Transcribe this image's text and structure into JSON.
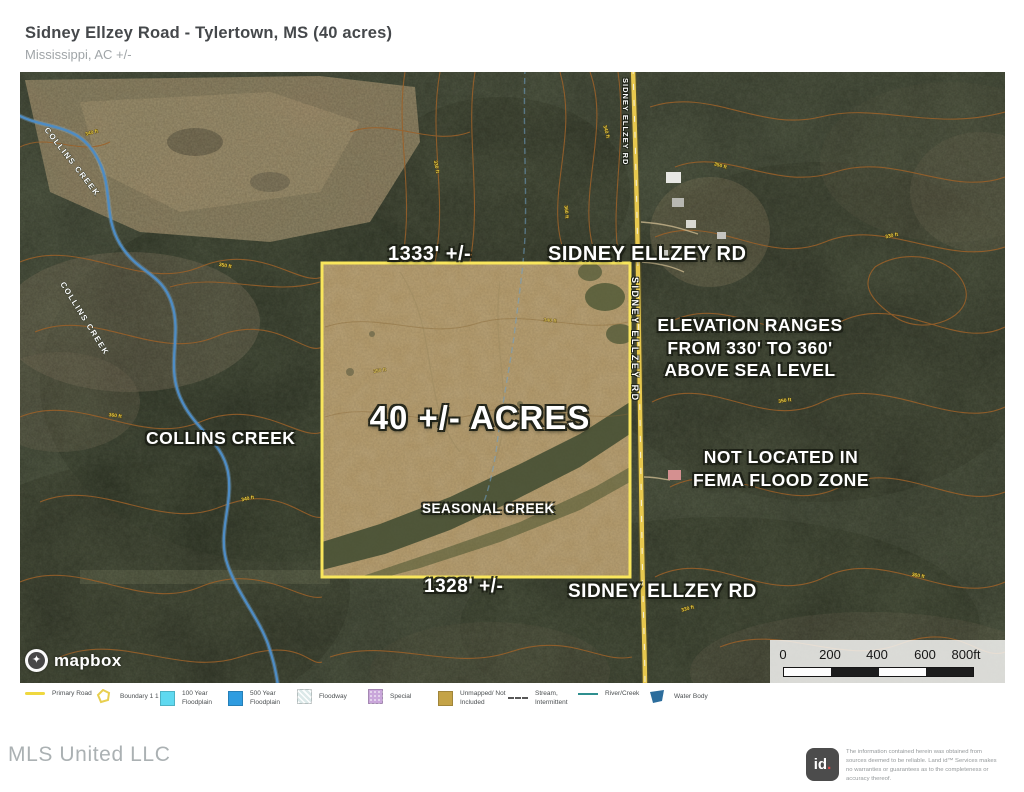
{
  "header": {
    "title": "Sidney Ellzey Road - Tylertown, MS (40 acres)",
    "subtitle": "Mississippi,  AC +/-"
  },
  "map": {
    "acres_label": "40 +/- ACRES",
    "top_boundary_length": "1333' +/-",
    "bottom_boundary_length": "1328' +/-",
    "road_name": "SIDNEY ELLZEY RD",
    "elevation_note": [
      "ELEVATION RANGES",
      "FROM 330' TO 360'",
      "ABOVE SEA LEVEL"
    ],
    "flood_note": [
      "NOT LOCATED IN",
      "FEMA FLOOD ZONE"
    ],
    "collins_creek_label": "COLLINS CREEK",
    "seasonal_creek_label": "SEASONAL CREEK",
    "contour_elevations": [
      "330 ft",
      "340 ft",
      "350 ft",
      "360 ft"
    ],
    "mapbox_wordmark": "mapbox",
    "scale_ticks": [
      "0",
      "200",
      "400",
      "600",
      "800ft"
    ],
    "colors": {
      "boundary": "#f9e65c",
      "road": "#e7c84e",
      "creek": "#4e8cc4",
      "contour": "#9c6129",
      "property_fill": "#b59b6b"
    }
  },
  "legend": {
    "items": [
      {
        "label": "Primary Road",
        "type": "line",
        "color": "#efd83f"
      },
      {
        "label": "Boundary 1 1 1",
        "type": "outline",
        "color": "#e8cf4f"
      },
      {
        "label": "100 Year Floodplain",
        "type": "square",
        "color": "#5fd9f0"
      },
      {
        "label": "500 Year Floodplain",
        "type": "square",
        "color": "#2f9ce0"
      },
      {
        "label": "Floodway",
        "type": "square-hatch",
        "color": "#dce9e9"
      },
      {
        "label": "Special",
        "type": "square-dots",
        "color": "#c9a6da"
      },
      {
        "label": "Unmapped/ Not Included",
        "type": "square",
        "color": "#c4a347"
      },
      {
        "label": "Stream, Intermittent",
        "type": "line-dashed",
        "color": "#585858"
      },
      {
        "label": "River/Creek",
        "type": "line",
        "color": "#2f8f8f"
      },
      {
        "label": "Water Body",
        "type": "polygon",
        "color": "#2c6d9c"
      }
    ]
  },
  "footer": {
    "brand": "MLS United LLC",
    "logo_id": "id",
    "logo_dot": ".",
    "disclaimer": "The information contained herein was obtained from sources deemed to be reliable.  Land id™ Services makes no warranties or guarantees as to the completeness or accuracy thereof."
  }
}
